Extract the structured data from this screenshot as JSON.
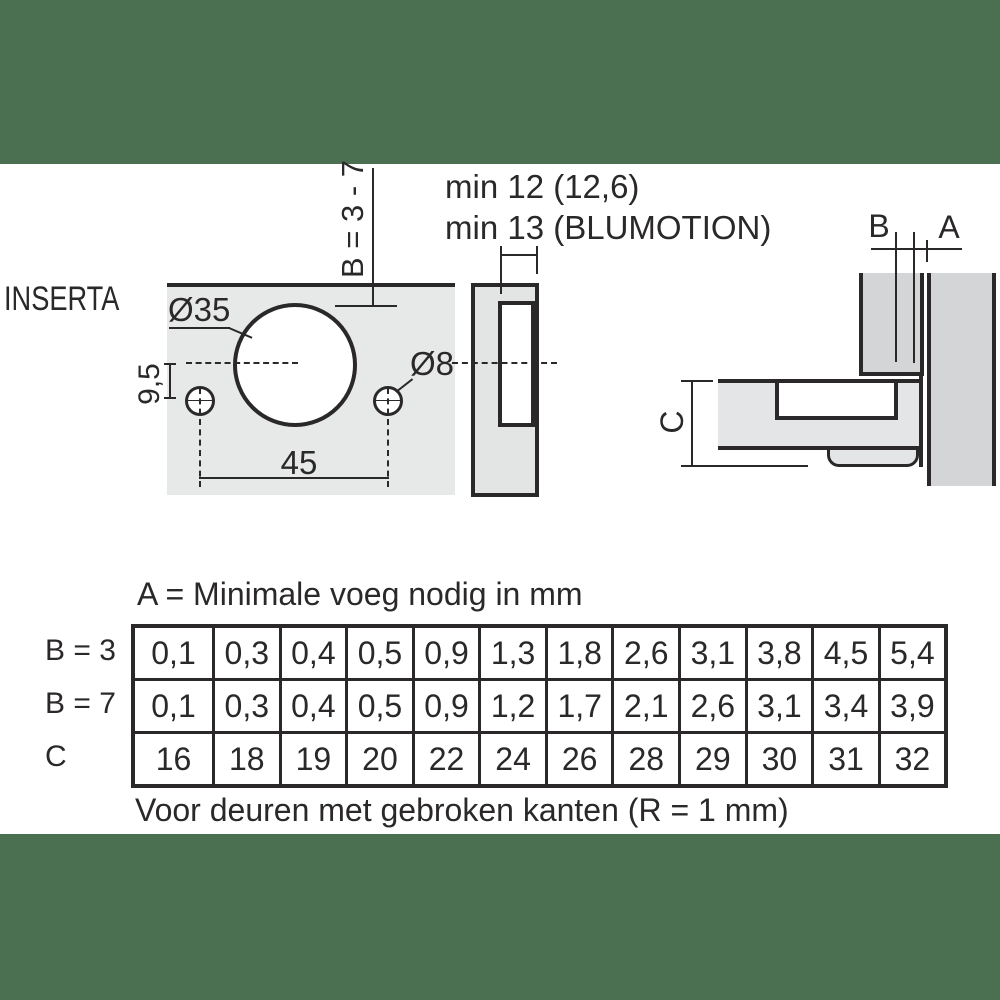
{
  "colors": {
    "band_green": "#4a7051",
    "ink": "#2b2829",
    "panel_light_gray": "#e7e8e8",
    "panel_mid_gray": "#e3e4e4",
    "panel_dark_gray": "#d3d5d6",
    "piece_gray": "#e4e5e6"
  },
  "inserta_label": "INSERTA",
  "front_view": {
    "cup_diameter_label": "Ø35",
    "hole_diameter_label": "Ø8",
    "vertical_offset_label": "9,5",
    "hole_spacing_label": "45",
    "drilling_distance_label": "B = 3 - 7"
  },
  "depth_notes": {
    "line1": "min 12 (12,6)",
    "line2": "min 13 (BLUMOTION)"
  },
  "section_view": {
    "gap_label_b": "B",
    "gap_label_a": "A",
    "height_label_c": "C"
  },
  "table": {
    "title": "A = Minimale voeg nodig in mm",
    "row_labels": [
      "B = 3",
      "B = 7",
      "C"
    ],
    "rows": [
      [
        "0,1",
        "0,3",
        "0,4",
        "0,5",
        "0,9",
        "1,3",
        "1,8",
        "2,6",
        "3,1",
        "3,8",
        "4,5",
        "5,4"
      ],
      [
        "0,1",
        "0,3",
        "0,4",
        "0,5",
        "0,9",
        "1,2",
        "1,7",
        "2,1",
        "2,6",
        "3,1",
        "3,4",
        "3,9"
      ],
      [
        "16",
        "18",
        "19",
        "20",
        "22",
        "24",
        "26",
        "28",
        "29",
        "30",
        "31",
        "32"
      ]
    ],
    "caption": "Voor deuren met gebroken kanten (R = 1 mm)"
  }
}
